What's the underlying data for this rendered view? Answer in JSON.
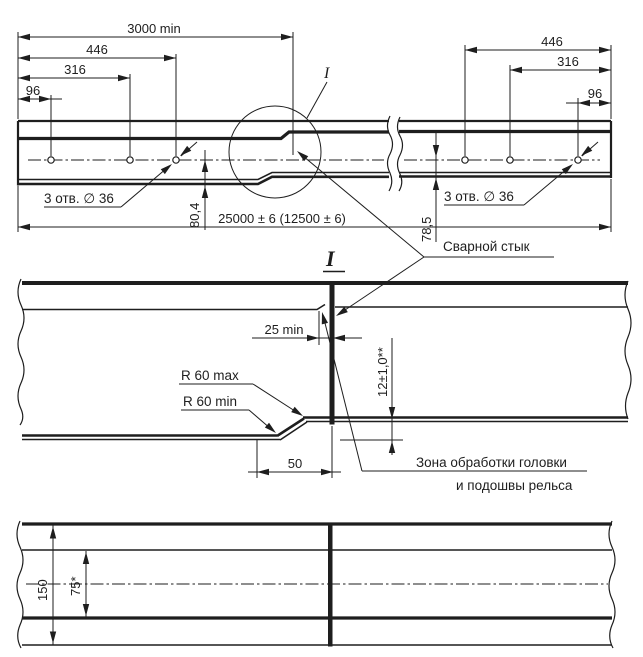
{
  "colors": {
    "ink": "#1e1e1e",
    "background": "#ffffff"
  },
  "overall_view": {
    "dim_3000": "3000 min",
    "dim_446_left": "446",
    "dim_316_left": "316",
    "dim_96_left": "96",
    "dim_446_right": "446",
    "dim_316_right": "316",
    "dim_96_right": "96",
    "holes_label_left": "3 отв. ∅ 36",
    "holes_label_right": "3 отв. ∅ 36",
    "dim_80_4": "80,4",
    "dim_78_5": "78,5",
    "dim_length": "25000 ± 6 (12500 ± 6)",
    "detail_mark": "I"
  },
  "detail_view": {
    "title": "I",
    "weld_label": "Сварной стык",
    "dim_25": "25 min",
    "dim_12": "12±1,0**",
    "radius_max": "R 60 max",
    "radius_min": "R 60 min",
    "dim_50": "50",
    "zone_label_line1": "Зона обработки головки",
    "zone_label_line2": "и подошвы рельса"
  },
  "plan_view": {
    "dim_150": "150",
    "dim_75": "75*"
  }
}
